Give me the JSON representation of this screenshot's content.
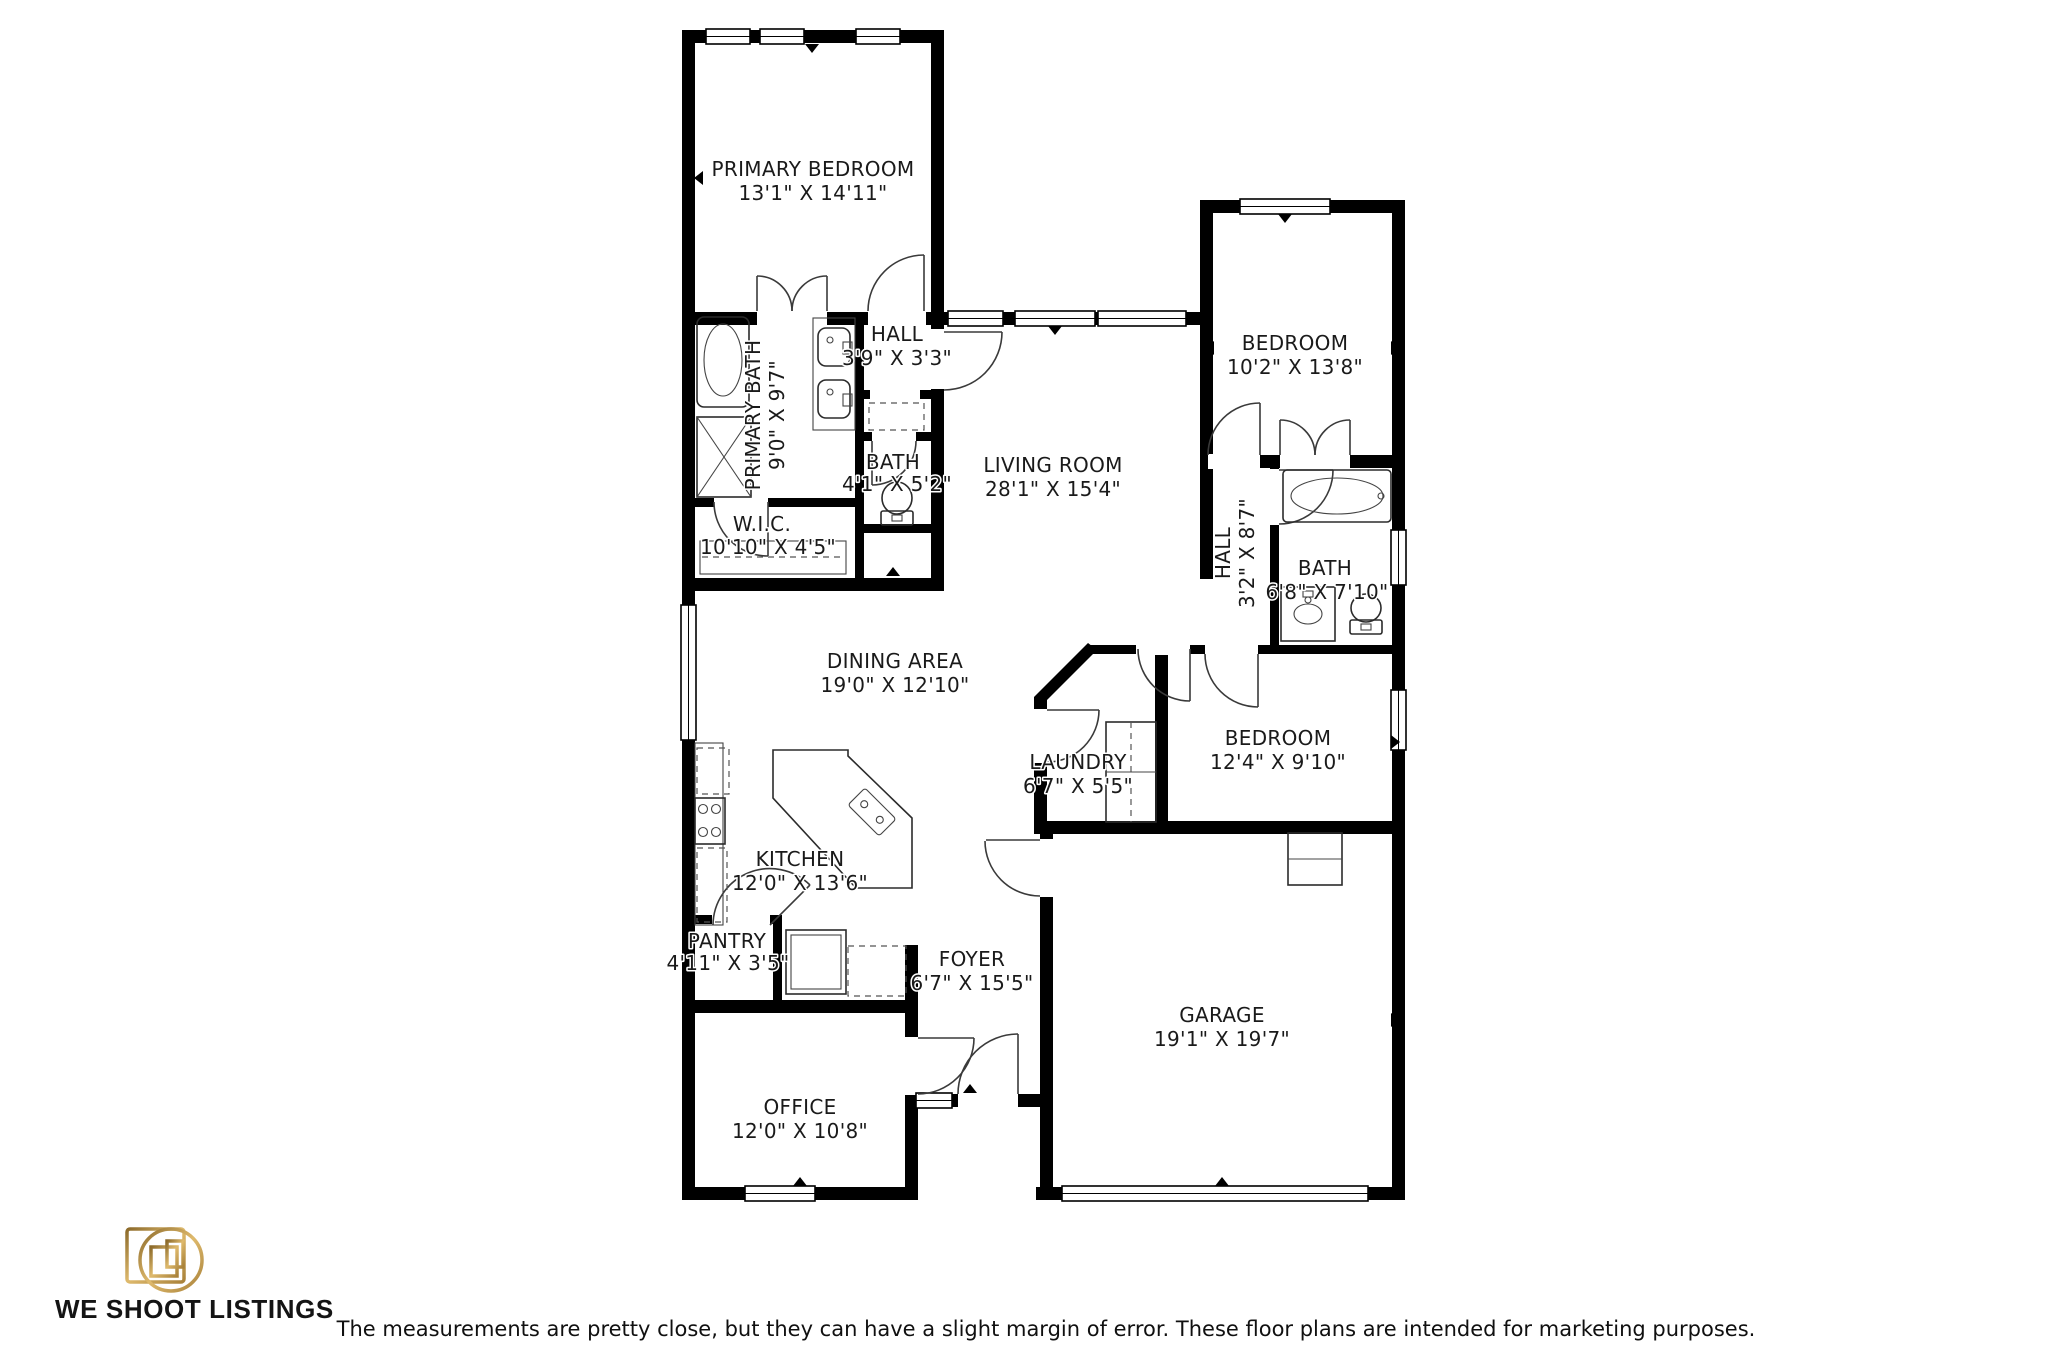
{
  "floorplan": {
    "rooms": [
      {
        "id": "primary-bedroom",
        "name": "PRIMARY BEDROOM",
        "dims": "13'1\" X 14'11\""
      },
      {
        "id": "hall-upper",
        "name": "HALL",
        "dims": "3'9\" X 3'3\""
      },
      {
        "id": "primary-bath",
        "name": "PRIMARY BATH",
        "dims": "9'0\" X 9'7\""
      },
      {
        "id": "bath-small",
        "name": "BATH",
        "dims": "4'1\" X 5'2\""
      },
      {
        "id": "wic",
        "name": "W.I.C.",
        "dims": "10'10\" X 4'5\""
      },
      {
        "id": "living-room",
        "name": "LIVING ROOM",
        "dims": "28'1\" X 15'4\""
      },
      {
        "id": "bedroom-upper",
        "name": "BEDROOM",
        "dims": "10'2\" X 13'8\""
      },
      {
        "id": "hall-right",
        "name": "HALL",
        "dims": "3'2\" X 8'7\""
      },
      {
        "id": "bath-right",
        "name": "BATH",
        "dims": "6'8\" X 7'10\""
      },
      {
        "id": "dining-area",
        "name": "DINING AREA",
        "dims": "19'0\" X 12'10\""
      },
      {
        "id": "bedroom-right",
        "name": "BEDROOM",
        "dims": "12'4\" X 9'10\""
      },
      {
        "id": "laundry",
        "name": "LAUNDRY",
        "dims": "6'7\" X 5'5\""
      },
      {
        "id": "kitchen",
        "name": "KITCHEN",
        "dims": "12'0\" X 13'6\""
      },
      {
        "id": "pantry",
        "name": "PANTRY",
        "dims": "4'11\" X 3'5\""
      },
      {
        "id": "foyer",
        "name": "FOYER",
        "dims": "6'7\" X 15'5\""
      },
      {
        "id": "garage",
        "name": "GARAGE",
        "dims": "19'1\" X 19'7\""
      },
      {
        "id": "office",
        "name": "OFFICE",
        "dims": "12'0\" X 10'8\""
      }
    ]
  },
  "branding": {
    "company": "WE SHOOT LISTINGS",
    "logo_icon": "camera-icon",
    "gold_dark": "#8c6a2a",
    "gold_light": "#e0bd70"
  },
  "footer": {
    "disclaimer": "The measurements are pretty close, but they can have a slight margin of error. These floor plans are intended for marketing purposes."
  },
  "colors": {
    "walls": "#000000",
    "background": "#ffffff",
    "label_text": "#1a1a1a",
    "label_halo": "#ffffff"
  }
}
